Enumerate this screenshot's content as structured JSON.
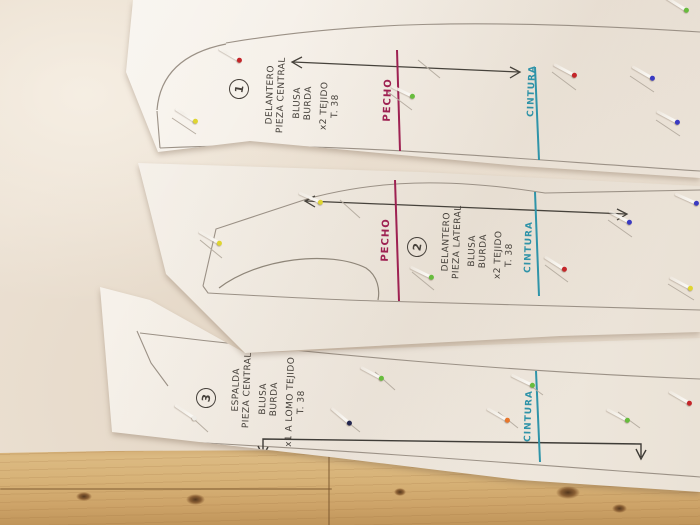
{
  "scene": {
    "description": "Three hand-drawn sewing pattern pieces for a blouse pinned to cream fabric on a pine table",
    "colors": {
      "fabric": "#ebe0d2",
      "paper": "#f6f1ea",
      "wood": "#d7b277",
      "ink": "#46413b",
      "pencil": "#9b9186",
      "bust_line": "#9e2152",
      "waist_line": "#2f93a8"
    },
    "pin_colors": [
      "red",
      "yellow",
      "green",
      "blue",
      "orange",
      "white",
      "navy"
    ]
  },
  "patterns": [
    {
      "number": "1",
      "piece_line1": "DELANTERO",
      "piece_line2": "PIEZA CENTRAL",
      "garment_line1": "BLUSA",
      "garment_line2": "BURDA",
      "cutting_line1": "x2 TEJIDO",
      "cutting_line2": "T. 38",
      "bust_label": "PECHO",
      "waist_label": "CINTURA"
    },
    {
      "number": "2",
      "piece_line1": "DELANTERO",
      "piece_line2": "PIEZA LATERAL",
      "garment_line1": "BLUSA",
      "garment_line2": "BURDA",
      "cutting_line1": "x2 TEJIDO",
      "cutting_line2": "T. 38",
      "bust_label": "PECHO",
      "waist_label": "CINTURA"
    },
    {
      "number": "3",
      "piece_line1": "ESPALDA",
      "piece_line2": "PIEZA CENTRAL",
      "garment_line1": "BLUSA",
      "garment_line2": "BURDA",
      "cutting_line1": "x1 A LOMO TEJIDO",
      "cutting_line2": "T. 38",
      "waist_label": "CINTURA"
    }
  ]
}
